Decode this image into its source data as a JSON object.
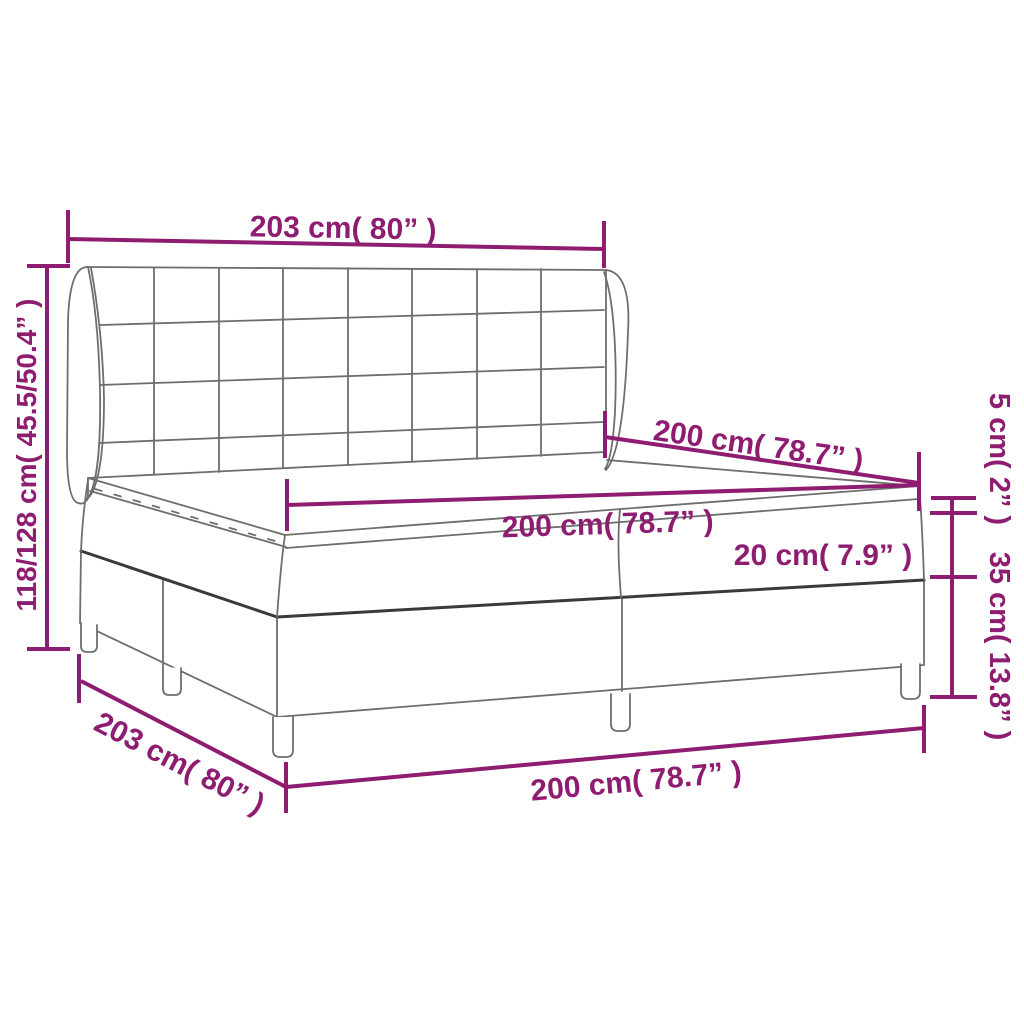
{
  "diagram": {
    "type": "product-dimension-diagram",
    "subject": "box-spring-bed-with-winged-tufted-headboard",
    "colors": {
      "dimension_accent": "#8E1C70",
      "drawing_line": "#6E6E6E",
      "drawing_line_dark": "#3A3A3A",
      "background": "#FFFFFF"
    },
    "labels": {
      "headboard_width_top": "203 cm( 80” )",
      "total_height_left": "118/128 cm( 45.5/50.4” )",
      "bed_length_upper": "200 cm( 78.7” )",
      "mattress_width_middle": "200 cm( 78.7” )",
      "topper_height_right": "5 cm( 2” )",
      "mattress_height_inner": "20 cm( 7.9” )",
      "base_height_right": "35 cm( 13.8” )",
      "base_width_bottom_left": "203 cm( 80” )",
      "base_length_bottom": "200 cm( 78.7” )"
    }
  }
}
